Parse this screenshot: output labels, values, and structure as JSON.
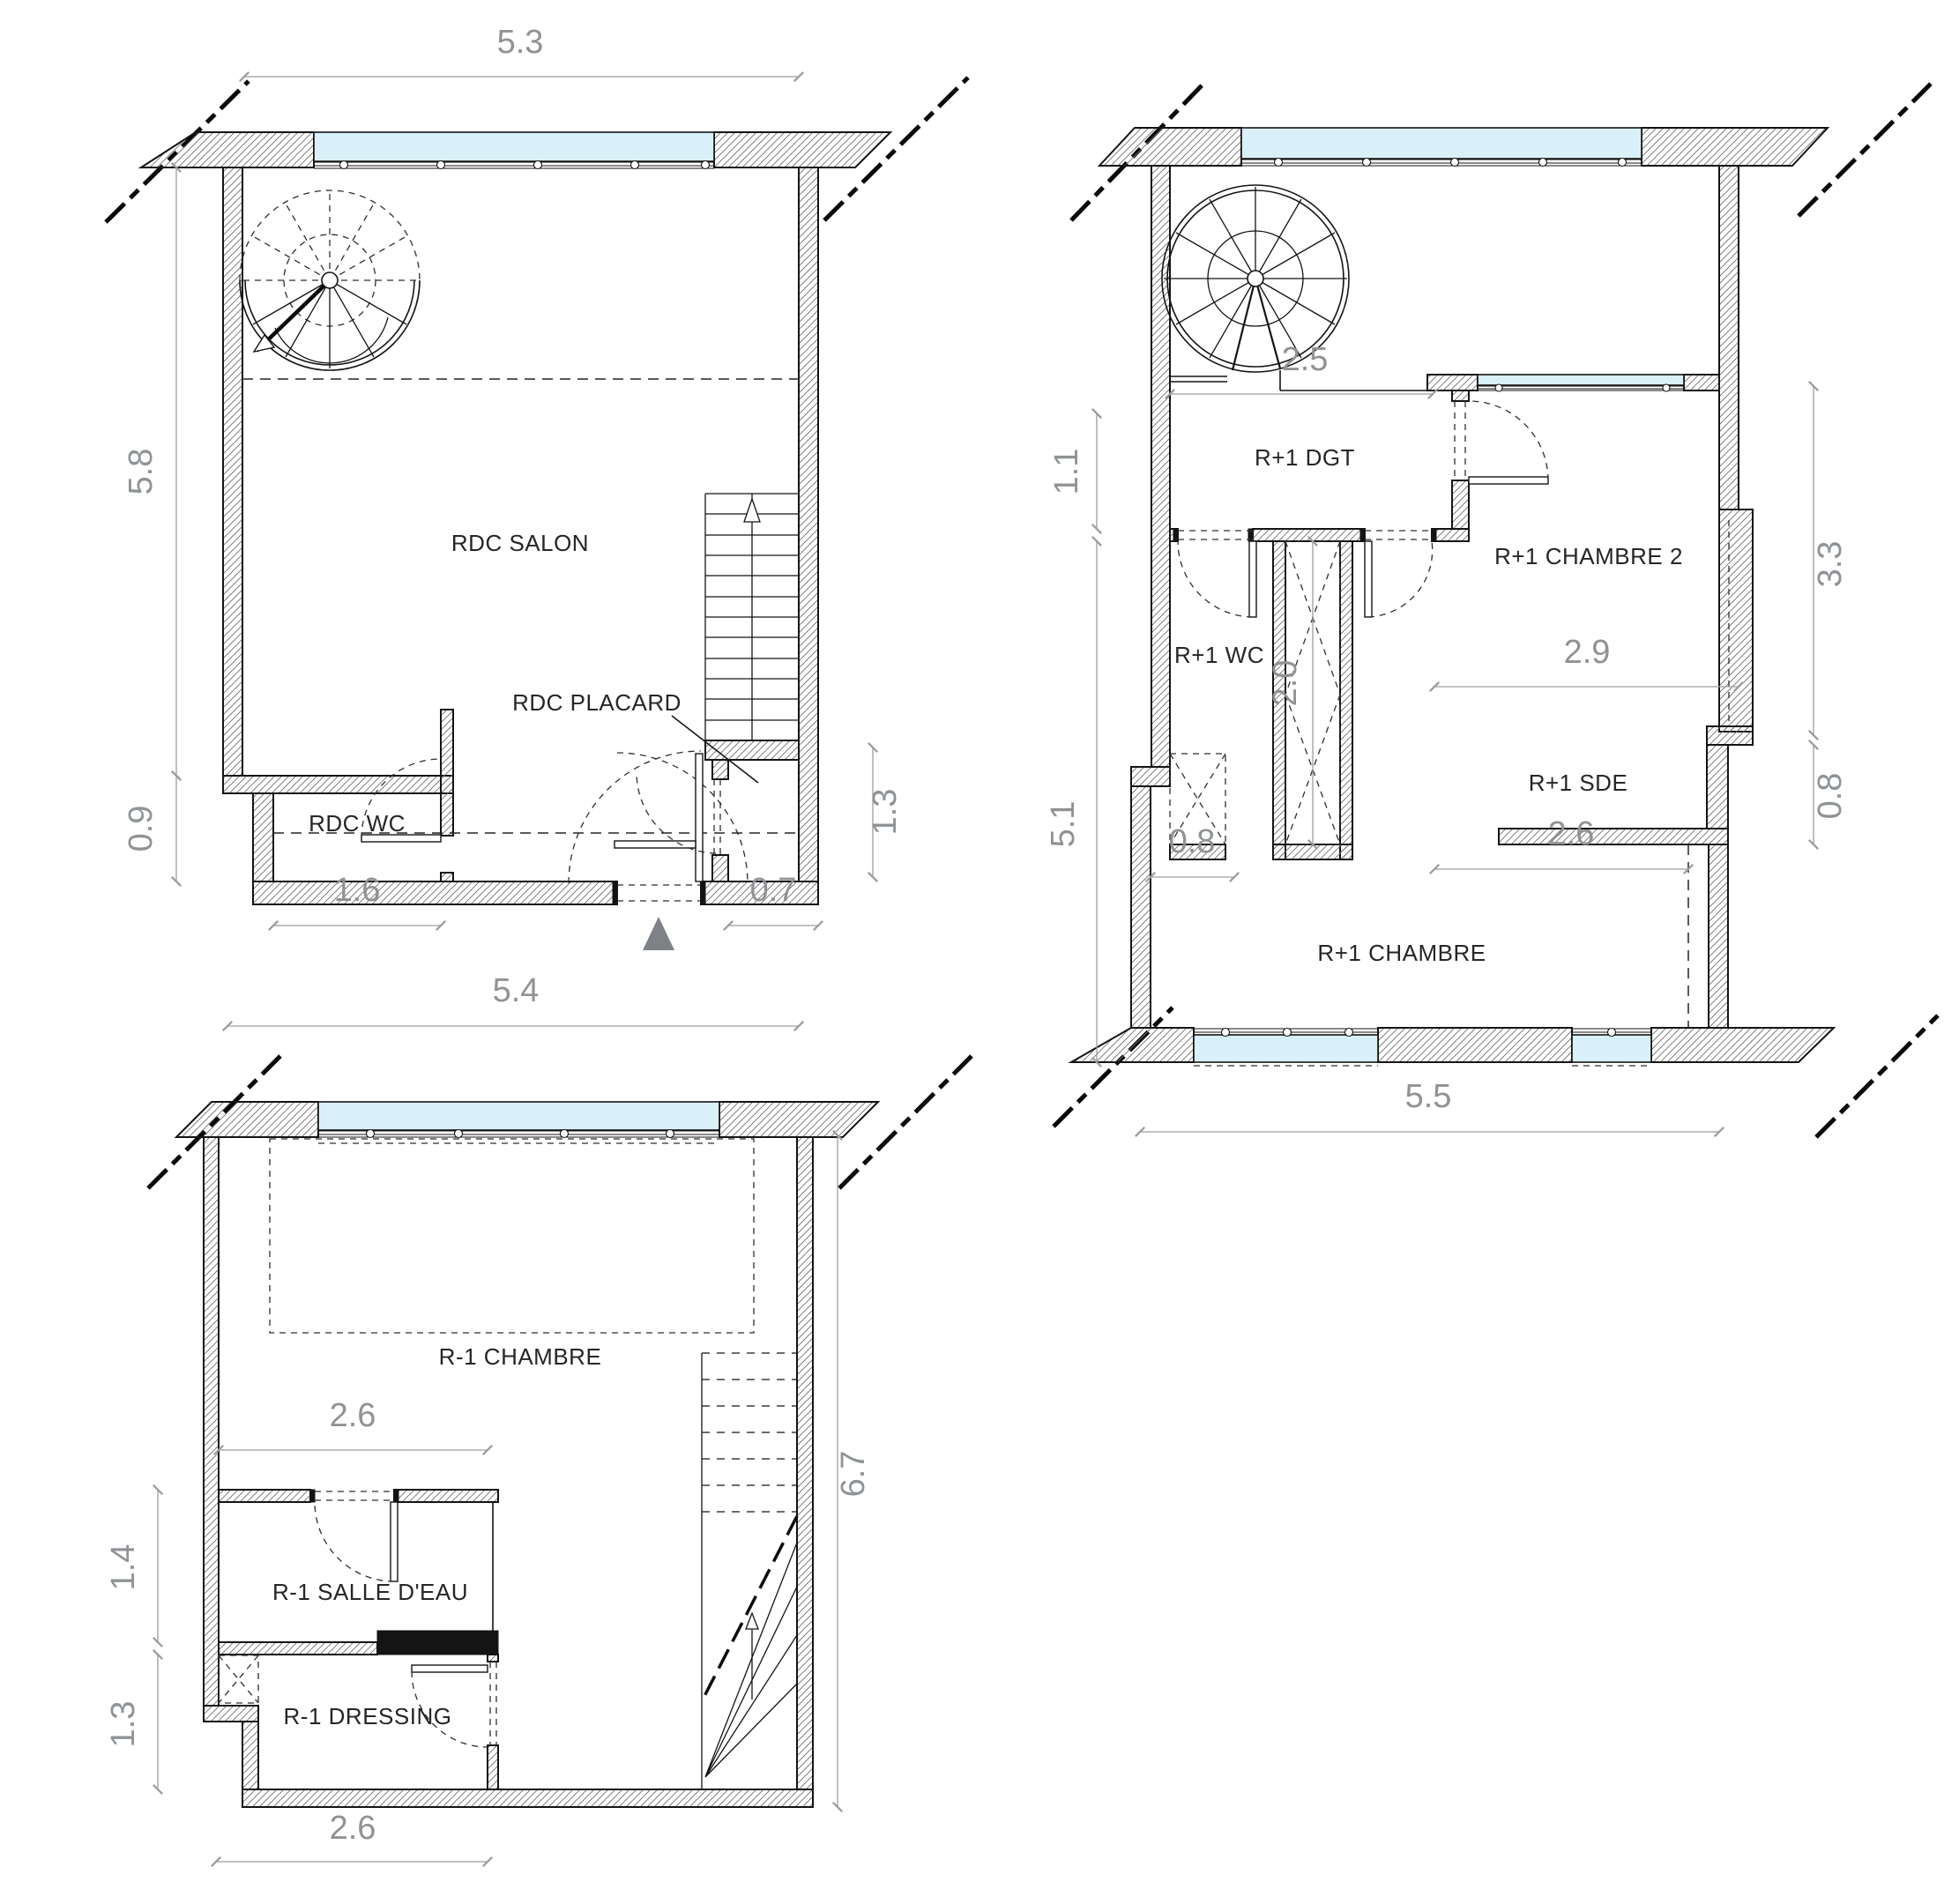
{
  "colors": {
    "window_glass": "#d9f0f8",
    "wall_line": "#141414",
    "hatch_line": "#6f6f6f",
    "dimension": "#8f9396",
    "label": "#262626",
    "entry_triangle": "#7e8286"
  },
  "plans": {
    "rdc": {
      "rooms": {
        "salon": "RDC SALON",
        "placard": "RDC PLACARD",
        "wc": "RDC WC"
      },
      "dims": {
        "width_top": "5.3",
        "height_left": "5.8",
        "wc_height": "0.9",
        "wc_width": "1.6",
        "entry_right": "0.7",
        "placard_height": "1.3"
      }
    },
    "rm1": {
      "rooms": {
        "chambre": "R-1 CHAMBRE",
        "salle_eau": "R-1 SALLE D'EAU",
        "dressing": "R-1 DRESSING"
      },
      "dims": {
        "width_top": "5.4",
        "salle_width": "2.6",
        "salle_height": "1.4",
        "dressing_height": "1.3",
        "dressing_width": "2.6",
        "height_right": "6.7"
      }
    },
    "rp1": {
      "rooms": {
        "dgt": "R+1 DGT",
        "wc": "R+1 WC",
        "chambre2": "R+1 CHAMBRE 2",
        "sde": "R+1 SDE",
        "chambre": "R+1 CHAMBRE"
      },
      "dims": {
        "spiral_width": "2.5",
        "dgt_height": "1.1",
        "closet_depth": "2.0",
        "wc_width": "0.8",
        "left_height": "5.1",
        "chambre2_width": "2.9",
        "chambre2_height": "3.3",
        "sde_height": "0.8",
        "sde_width": "2.6",
        "width_bottom": "5.5"
      }
    }
  }
}
